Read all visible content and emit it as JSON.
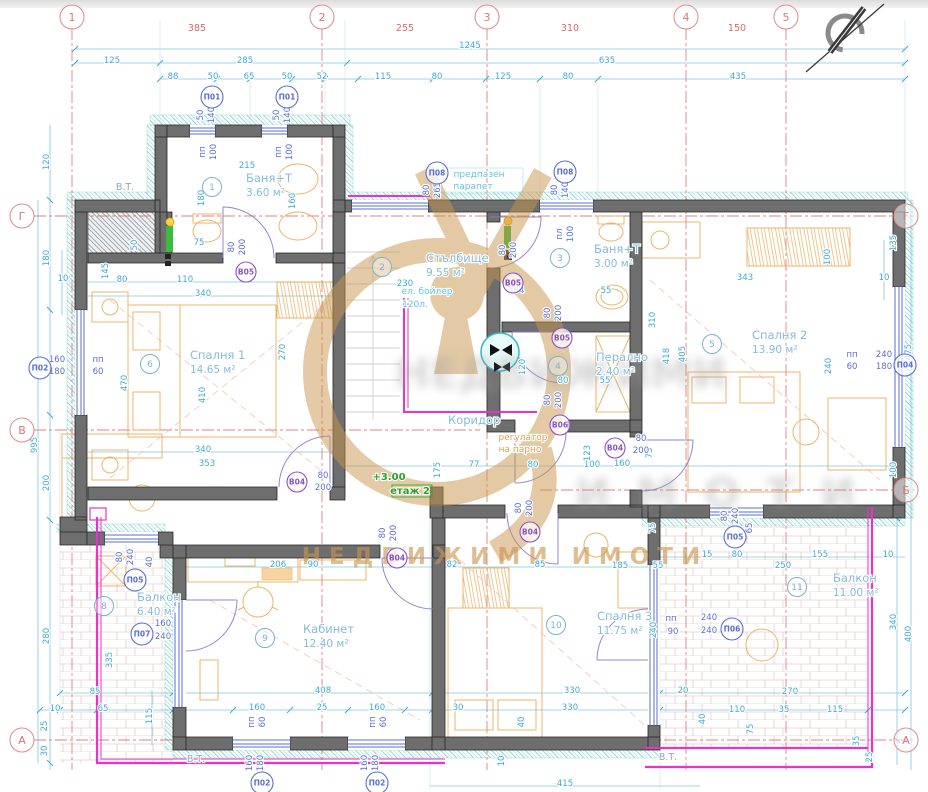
{
  "watermark": {
    "brand": "НЕДВИЖИМИ ИМОТИ",
    "blur1": "НЕДВИЖИМИ",
    "blur2": "ИМОТИ"
  },
  "axes": {
    "top": [
      {
        "t": "1",
        "x": 72
      },
      {
        "t": "2",
        "x": 322
      },
      {
        "t": "3",
        "x": 487
      },
      {
        "t": "4",
        "x": 686
      },
      {
        "t": "5",
        "x": 786
      }
    ],
    "left": [
      {
        "t": "Г",
        "y": 216
      },
      {
        "t": "В",
        "y": 430
      },
      {
        "t": "А",
        "y": 740
      }
    ],
    "right": [
      {
        "t": "Г",
        "y": 216
      },
      {
        "t": "Б",
        "y": 490
      },
      {
        "t": "А",
        "y": 740
      }
    ]
  },
  "rooms": [
    {
      "n": "1",
      "name": "Баня+Т",
      "area": "3.60 м²",
      "cx": 212,
      "cy": 187,
      "tx": 246,
      "ty": 182
    },
    {
      "n": "2",
      "name": "Стълбище",
      "area": "9.55 м²",
      "cx": 382,
      "cy": 267,
      "tx": 426,
      "ty": 262
    },
    {
      "n": "3",
      "name": "Баня+Т",
      "area": "3.00 м²",
      "cx": 560,
      "cy": 258,
      "tx": 594,
      "ty": 253
    },
    {
      "n": "4",
      "name": "Перално",
      "area": "2.40 м²",
      "cx": 558,
      "cy": 366,
      "tx": 596,
      "ty": 361
    },
    {
      "n": "5",
      "name": "Спалня 2",
      "area": "13.90 м²",
      "cx": 712,
      "cy": 344,
      "tx": 752,
      "ty": 339
    },
    {
      "n": "6",
      "name": "Спалня 1",
      "area": "14.65 м²",
      "cx": 150,
      "cy": 364,
      "tx": 190,
      "ty": 359
    },
    {
      "n": "7",
      "name": "Коридор",
      "area": "",
      "cx": 0,
      "cy": 0,
      "tx": 448,
      "ty": 424
    },
    {
      "n": "8",
      "name": "Балкон",
      "area": "6.40 м²",
      "cx": 104,
      "cy": 606,
      "tx": 137,
      "ty": 601
    },
    {
      "n": "9",
      "name": "Кабинет",
      "area": "12.40 м²",
      "cx": 265,
      "cy": 638,
      "tx": 303,
      "ty": 633
    },
    {
      "n": "10",
      "name": "Спалня 3",
      "area": "11.75 м²",
      "cx": 556,
      "cy": 625,
      "tx": 597,
      "ty": 620
    },
    {
      "n": "11",
      "name": "Балкон",
      "area": "11.00 м²",
      "cx": 797,
      "cy": 587,
      "tx": 833,
      "ty": 582
    }
  ],
  "window_tags": [
    {
      "t": "П01",
      "x": 212,
      "y": 97
    },
    {
      "t": "П01",
      "x": 287,
      "y": 97
    },
    {
      "t": "П08",
      "x": 437,
      "y": 173
    },
    {
      "t": "П08",
      "x": 565,
      "y": 172
    },
    {
      "t": "П02",
      "x": 40,
      "y": 368
    },
    {
      "t": "П04",
      "x": 905,
      "y": 365
    },
    {
      "t": "П05",
      "x": 135,
      "y": 580
    },
    {
      "t": "П07",
      "x": 142,
      "y": 634
    },
    {
      "t": "П05",
      "x": 735,
      "y": 537
    },
    {
      "t": "П06",
      "x": 732,
      "y": 629
    },
    {
      "t": "П02",
      "x": 262,
      "y": 783
    },
    {
      "t": "П02",
      "x": 377,
      "y": 783
    }
  ],
  "door_tags": [
    {
      "t": "В05",
      "x": 246,
      "y": 272
    },
    {
      "t": "В05",
      "x": 513,
      "y": 283
    },
    {
      "t": "В05",
      "x": 562,
      "y": 338
    },
    {
      "t": "В06",
      "x": 560,
      "y": 425
    },
    {
      "t": "В04",
      "x": 297,
      "y": 482
    },
    {
      "t": "В04",
      "x": 615,
      "y": 448
    },
    {
      "t": "В04",
      "x": 530,
      "y": 532
    },
    {
      "t": "В04",
      "x": 397,
      "y": 558
    }
  ],
  "dims": [
    {
      "t": "385",
      "x": 197,
      "y": 31,
      "c": "r"
    },
    {
      "t": "255",
      "x": 405,
      "y": 31,
      "c": "r"
    },
    {
      "t": "310",
      "x": 570,
      "y": 31,
      "c": "r"
    },
    {
      "t": "150",
      "x": 737,
      "y": 31,
      "c": "r"
    },
    {
      "t": "1245",
      "x": 470,
      "y": 48
    },
    {
      "t": "125",
      "x": 112,
      "y": 63
    },
    {
      "t": "285",
      "x": 245,
      "y": 63
    },
    {
      "t": "635",
      "x": 607,
      "y": 63
    },
    {
      "t": "88",
      "x": 173,
      "y": 79
    },
    {
      "t": "50",
      "x": 213,
      "y": 79
    },
    {
      "t": "65",
      "x": 249,
      "y": 79
    },
    {
      "t": "50",
      "x": 287,
      "y": 79
    },
    {
      "t": "52",
      "x": 322,
      "y": 79
    },
    {
      "t": "115",
      "x": 383,
      "y": 79
    },
    {
      "t": "80",
      "x": 437,
      "y": 79
    },
    {
      "t": "125",
      "x": 503,
      "y": 79
    },
    {
      "t": "80",
      "x": 568,
      "y": 79
    },
    {
      "t": "435",
      "x": 738,
      "y": 79
    },
    {
      "t": "120",
      "x": 49,
      "y": 162,
      "r": 1
    },
    {
      "t": "180",
      "x": 49,
      "y": 258,
      "r": 1
    },
    {
      "t": "10",
      "x": 63,
      "y": 281
    },
    {
      "t": "995",
      "x": 37,
      "y": 445,
      "r": 1
    },
    {
      "t": "200",
      "x": 49,
      "y": 483,
      "r": 1
    },
    {
      "t": "280",
      "x": 49,
      "y": 636,
      "r": 1
    },
    {
      "t": "25",
      "x": 47,
      "y": 726,
      "r": 1
    },
    {
      "t": "30",
      "x": 47,
      "y": 751,
      "r": 1
    },
    {
      "t": "135",
      "x": 896,
      "y": 243,
      "r": 1
    },
    {
      "t": "10",
      "x": 884,
      "y": 280
    },
    {
      "t": "475",
      "x": 911,
      "y": 352,
      "r": 1
    },
    {
      "t": "100",
      "x": 896,
      "y": 470,
      "r": 1
    },
    {
      "t": "340",
      "x": 896,
      "y": 622,
      "r": 1
    },
    {
      "t": "400",
      "x": 911,
      "y": 634,
      "r": 1
    },
    {
      "t": "35",
      "x": 859,
      "y": 741,
      "r": 1
    },
    {
      "t": "25",
      "x": 872,
      "y": 757,
      "r": 1
    },
    {
      "t": "85",
      "x": 95,
      "y": 694
    },
    {
      "t": "408",
      "x": 323,
      "y": 693
    },
    {
      "t": "330",
      "x": 572,
      "y": 693
    },
    {
      "t": "20",
      "x": 683,
      "y": 693
    },
    {
      "t": "270",
      "x": 790,
      "y": 694
    },
    {
      "t": "10",
      "x": 55,
      "y": 711
    },
    {
      "t": "65",
      "x": 103,
      "y": 711
    },
    {
      "t": "160",
      "x": 257,
      "y": 710
    },
    {
      "t": "25",
      "x": 322,
      "y": 710
    },
    {
      "t": "160",
      "x": 377,
      "y": 710
    },
    {
      "t": "30",
      "x": 458,
      "y": 710
    },
    {
      "t": "330",
      "x": 570,
      "y": 710
    },
    {
      "t": "110",
      "x": 737,
      "y": 712
    },
    {
      "t": "35",
      "x": 784,
      "y": 712
    },
    {
      "t": "115",
      "x": 835,
      "y": 712
    },
    {
      "t": "415",
      "x": 565,
      "y": 786
    },
    {
      "t": "115",
      "x": 152,
      "y": 716,
      "r": 1
    },
    {
      "t": "75",
      "x": 753,
      "y": 729,
      "r": 1
    },
    {
      "t": "40",
      "x": 524,
      "y": 722,
      "r": 1
    },
    {
      "t": "10",
      "x": 504,
      "y": 761,
      "r": 1
    },
    {
      "t": "40",
      "x": 705,
      "y": 719,
      "r": 1
    },
    {
      "t": "215",
      "x": 247,
      "y": 168
    },
    {
      "t": "75",
      "x": 199,
      "y": 245
    },
    {
      "t": "80",
      "x": 122,
      "y": 282
    },
    {
      "t": "110",
      "x": 185,
      "y": 282
    },
    {
      "t": "340",
      "x": 203,
      "y": 296
    },
    {
      "t": "145",
      "x": 108,
      "y": 271,
      "r": 1
    },
    {
      "t": "50",
      "x": 137,
      "y": 245,
      "r": 1
    },
    {
      "t": "180",
      "x": 204,
      "y": 198,
      "r": 1
    },
    {
      "t": "160",
      "x": 295,
      "y": 201,
      "r": 1
    },
    {
      "t": "470",
      "x": 127,
      "y": 383,
      "r": 1
    },
    {
      "t": "410",
      "x": 205,
      "y": 395,
      "r": 1
    },
    {
      "t": "340",
      "x": 203,
      "y": 452
    },
    {
      "t": "353",
      "x": 207,
      "y": 466
    },
    {
      "t": "270",
      "x": 285,
      "y": 352,
      "r": 1
    },
    {
      "t": "230",
      "x": 405,
      "y": 286
    },
    {
      "t": "64",
      "x": 519,
      "y": 293
    },
    {
      "t": "55",
      "x": 606,
      "y": 293
    },
    {
      "t": "120",
      "x": 525,
      "y": 367,
      "r": 1
    },
    {
      "t": "80",
      "x": 563,
      "y": 383
    },
    {
      "t": "55",
      "x": 605,
      "y": 383
    },
    {
      "t": "310",
      "x": 655,
      "y": 320,
      "r": 1
    },
    {
      "t": "418",
      "x": 669,
      "y": 356,
      "r": 1
    },
    {
      "t": "343",
      "x": 745,
      "y": 280
    },
    {
      "t": "100",
      "x": 830,
      "y": 257,
      "r": 1
    },
    {
      "t": "405",
      "x": 685,
      "y": 354,
      "r": 1
    },
    {
      "t": "240",
      "x": 831,
      "y": 366,
      "r": 1
    },
    {
      "t": "175",
      "x": 440,
      "y": 470,
      "r": 1
    },
    {
      "t": "77",
      "x": 474,
      "y": 467
    },
    {
      "t": "80",
      "x": 533,
      "y": 467
    },
    {
      "t": "100",
      "x": 592,
      "y": 467
    },
    {
      "t": "123",
      "x": 590,
      "y": 453,
      "r": 1
    },
    {
      "t": "160",
      "x": 622,
      "y": 466
    },
    {
      "t": "73",
      "x": 652,
      "y": 453,
      "r": 1
    },
    {
      "t": "206",
      "x": 278,
      "y": 567
    },
    {
      "t": "90",
      "x": 313,
      "y": 567
    },
    {
      "t": "82",
      "x": 452,
      "y": 567
    },
    {
      "t": "85",
      "x": 540,
      "y": 567
    },
    {
      "t": "185",
      "x": 620,
      "y": 568
    },
    {
      "t": "55",
      "x": 658,
      "y": 568
    },
    {
      "t": "335",
      "x": 112,
      "y": 660,
      "r": 1
    },
    {
      "t": "75",
      "x": 655,
      "y": 528,
      "r": 1
    },
    {
      "t": "240",
      "x": 656,
      "y": 630,
      "r": 1
    },
    {
      "t": "15",
      "x": 707,
      "y": 557
    },
    {
      "t": "80",
      "x": 737,
      "y": 557
    },
    {
      "t": "155",
      "x": 820,
      "y": 557
    },
    {
      "t": "250",
      "x": 783,
      "y": 568
    },
    {
      "t": "10",
      "x": 888,
      "y": 557
    },
    {
      "t": "50",
      "x": 203,
      "y": 115,
      "r": 1,
      "c": "b"
    },
    {
      "t": "140",
      "x": 214,
      "y": 115,
      "r": 1,
      "c": "b"
    },
    {
      "t": "пп",
      "x": 205,
      "y": 152,
      "r": 1,
      "c": "b"
    },
    {
      "t": "100",
      "x": 216,
      "y": 152,
      "r": 1,
      "c": "b"
    },
    {
      "t": "50",
      "x": 279,
      "y": 115,
      "r": 1,
      "c": "b"
    },
    {
      "t": "140",
      "x": 290,
      "y": 115,
      "r": 1,
      "c": "b"
    },
    {
      "t": "пп",
      "x": 281,
      "y": 152,
      "r": 1,
      "c": "b"
    },
    {
      "t": "100",
      "x": 292,
      "y": 152,
      "r": 1,
      "c": "b"
    },
    {
      "t": "80",
      "x": 429,
      "y": 190,
      "r": 1,
      "c": "b"
    },
    {
      "t": "265",
      "x": 440,
      "y": 190,
      "r": 1,
      "c": "b"
    },
    {
      "t": "80",
      "x": 557,
      "y": 190,
      "r": 1,
      "c": "b"
    },
    {
      "t": "140",
      "x": 568,
      "y": 190,
      "r": 1,
      "c": "b"
    },
    {
      "t": "пл",
      "x": 562,
      "y": 234,
      "r": 1,
      "c": "b"
    },
    {
      "t": "100",
      "x": 573,
      "y": 234,
      "r": 1,
      "c": "b"
    },
    {
      "t": "160",
      "x": 57,
      "y": 362,
      "c": "b"
    },
    {
      "t": "180",
      "x": 57,
      "y": 374,
      "c": "b"
    },
    {
      "t": "пп",
      "x": 98,
      "y": 362,
      "c": "b"
    },
    {
      "t": "60",
      "x": 98,
      "y": 374,
      "c": "b"
    },
    {
      "t": "240",
      "x": 884,
      "y": 357,
      "c": "b"
    },
    {
      "t": "180",
      "x": 884,
      "y": 369,
      "c": "b"
    },
    {
      "t": "пп",
      "x": 852,
      "y": 357,
      "c": "b"
    },
    {
      "t": "60",
      "x": 852,
      "y": 369,
      "c": "b"
    },
    {
      "t": "80",
      "x": 122,
      "y": 557,
      "r": 1,
      "c": "b"
    },
    {
      "t": "240",
      "x": 133,
      "y": 557,
      "r": 1,
      "c": "b"
    },
    {
      "t": "40",
      "x": 152,
      "y": 562,
      "r": 1,
      "c": "b"
    },
    {
      "t": "160",
      "x": 163,
      "y": 626,
      "c": "b"
    },
    {
      "t": "240",
      "x": 163,
      "y": 639,
      "c": "b"
    },
    {
      "t": "80",
      "x": 727,
      "y": 516,
      "r": 1,
      "c": "b"
    },
    {
      "t": "240",
      "x": 738,
      "y": 516,
      "r": 1,
      "c": "b"
    },
    {
      "t": "65",
      "x": 752,
      "y": 528,
      "r": 1,
      "c": "b"
    },
    {
      "t": "240",
      "x": 709,
      "y": 620,
      "c": "b"
    },
    {
      "t": "240",
      "x": 709,
      "y": 633,
      "c": "b"
    },
    {
      "t": "пп",
      "x": 671,
      "y": 621,
      "c": "b"
    },
    {
      "t": "90",
      "x": 673,
      "y": 634,
      "c": "b"
    },
    {
      "t": "160",
      "x": 252,
      "y": 763,
      "r": 1,
      "c": "b"
    },
    {
      "t": "180",
      "x": 263,
      "y": 763,
      "r": 1,
      "c": "b"
    },
    {
      "t": "пп",
      "x": 254,
      "y": 722,
      "r": 1,
      "c": "b"
    },
    {
      "t": "60",
      "x": 265,
      "y": 722,
      "r": 1,
      "c": "b"
    },
    {
      "t": "160",
      "x": 367,
      "y": 763,
      "r": 1,
      "c": "b"
    },
    {
      "t": "180",
      "x": 378,
      "y": 763,
      "r": 1,
      "c": "b"
    },
    {
      "t": "пп",
      "x": 375,
      "y": 722,
      "r": 1,
      "c": "b"
    },
    {
      "t": "60",
      "x": 386,
      "y": 722,
      "r": 1,
      "c": "b"
    },
    {
      "t": "80",
      "x": 234,
      "y": 247,
      "r": 1,
      "c": "b"
    },
    {
      "t": "200",
      "x": 245,
      "y": 247,
      "r": 1,
      "c": "b"
    },
    {
      "t": "80",
      "x": 505,
      "y": 250,
      "r": 1,
      "c": "b"
    },
    {
      "t": "200",
      "x": 516,
      "y": 250,
      "r": 1,
      "c": "b"
    },
    {
      "t": "80",
      "x": 550,
      "y": 313,
      "r": 1,
      "c": "b"
    },
    {
      "t": "200",
      "x": 561,
      "y": 313,
      "r": 1,
      "c": "b"
    },
    {
      "t": "80",
      "x": 550,
      "y": 400,
      "r": 1,
      "c": "b"
    },
    {
      "t": "200",
      "x": 561,
      "y": 400,
      "r": 1,
      "c": "b"
    },
    {
      "t": "80",
      "x": 521,
      "y": 508,
      "r": 1,
      "c": "b"
    },
    {
      "t": "200",
      "x": 532,
      "y": 508,
      "r": 1,
      "c": "b"
    },
    {
      "t": "80",
      "x": 385,
      "y": 533,
      "r": 1,
      "c": "b"
    },
    {
      "t": "200",
      "x": 396,
      "y": 533,
      "r": 1,
      "c": "b"
    },
    {
      "t": "80",
      "x": 323,
      "y": 478,
      "c": "b"
    },
    {
      "t": "200",
      "x": 323,
      "y": 490,
      "c": "b"
    },
    {
      "t": "80",
      "x": 641,
      "y": 441,
      "c": "b"
    },
    {
      "t": "200",
      "x": 641,
      "y": 453,
      "c": "b"
    }
  ],
  "notes": [
    {
      "t": "В.Т.",
      "x": 125,
      "y": 190,
      "c": "grey"
    },
    {
      "t": "В.Т.",
      "x": 196,
      "y": 762,
      "c": "grey"
    },
    {
      "t": "В.Т.",
      "x": 668,
      "y": 760,
      "c": "grey"
    },
    {
      "t": "предпазен",
      "x": 479,
      "y": 177,
      "c": "cy2"
    },
    {
      "t": "парапет",
      "x": 473,
      "y": 189,
      "c": "cy2"
    },
    {
      "t": "ел. бойлер",
      "x": 427,
      "y": 294,
      "c": "cy2"
    },
    {
      "t": "120л.",
      "x": 415,
      "y": 307,
      "c": "cy2"
    },
    {
      "t": "+3.00",
      "x": 389,
      "y": 480,
      "c": "green"
    },
    {
      "t": "етаж 2",
      "x": 410,
      "y": 494,
      "c": "green"
    },
    {
      "t": "регулатор",
      "x": 523,
      "y": 440,
      "c": "orange"
    },
    {
      "t": "на парно",
      "x": 520,
      "y": 452,
      "c": "orange"
    }
  ]
}
